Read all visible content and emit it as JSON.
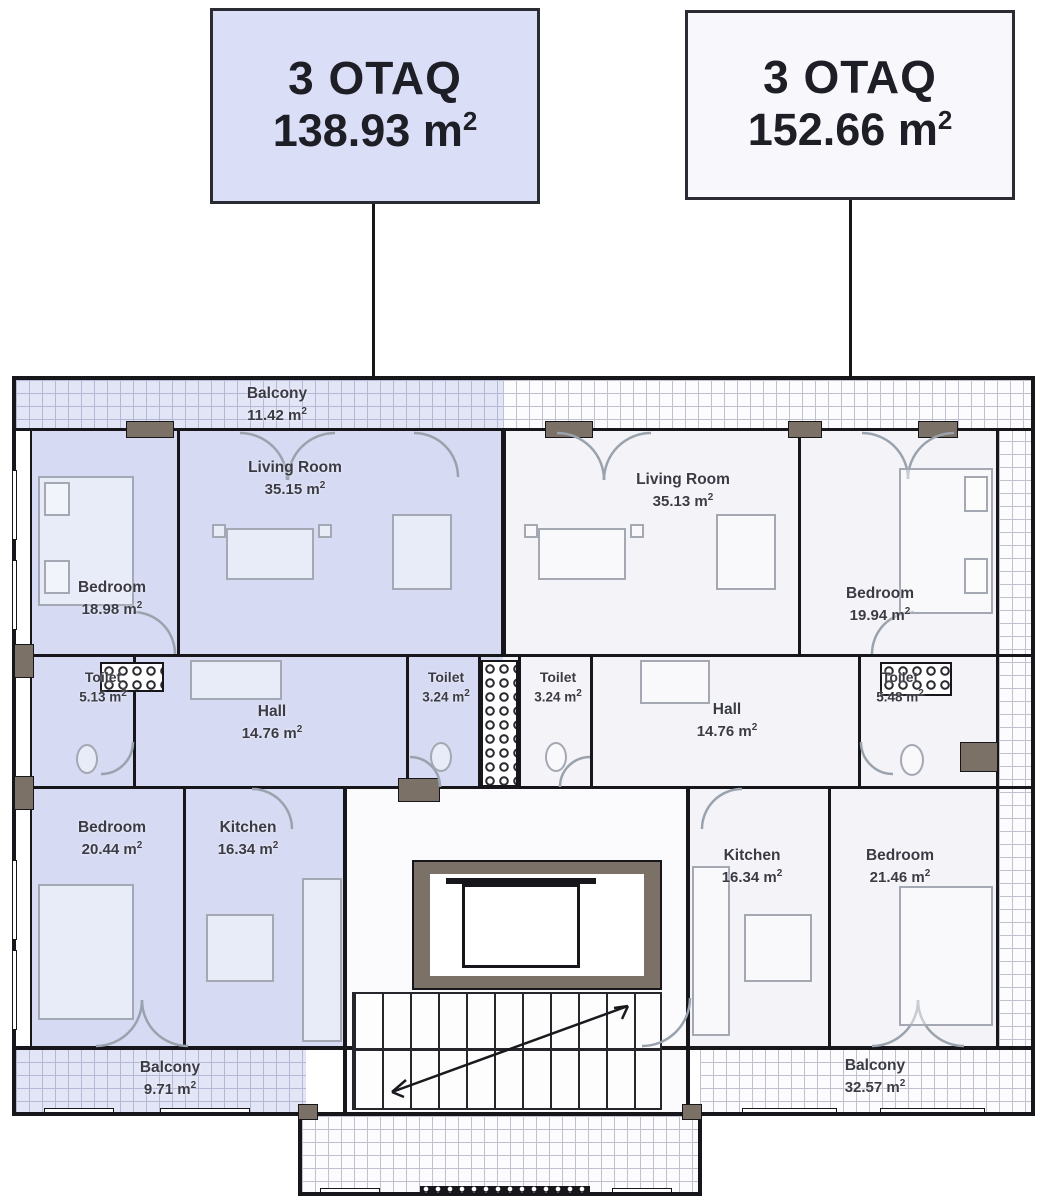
{
  "callouts": [
    {
      "title": "3 OTAQ",
      "area": "138.93"
    },
    {
      "title": "3 OTAQ",
      "area": "152.66"
    }
  ],
  "units": {
    "suffix": " m",
    "exp": "2"
  },
  "rooms": {
    "balcony_top": {
      "name": "Balcony",
      "area": "11.42"
    },
    "bedroom1": {
      "name": "Bedroom",
      "area": "18.98"
    },
    "living1": {
      "name": "Living Room",
      "area": "35.15"
    },
    "toilet1": {
      "name": "Toilet",
      "area": "5.13"
    },
    "hall1": {
      "name": "Hall",
      "area": "14.76"
    },
    "toilet2": {
      "name": "Toilet",
      "area": "3.24"
    },
    "bedroom2": {
      "name": "Bedroom",
      "area": "20.44"
    },
    "kitchen1": {
      "name": "Kitchen",
      "area": "16.34"
    },
    "balcony_left": {
      "name": "Balcony",
      "area": "9.71"
    },
    "living2": {
      "name": "Living Room",
      "area": "35.13"
    },
    "bedroom3": {
      "name": "Bedroom",
      "area": "19.94"
    },
    "toilet3": {
      "name": "Toilet",
      "area": "3.24"
    },
    "hall2": {
      "name": "Hall",
      "area": "14.76"
    },
    "toilet4": {
      "name": "Toilet",
      "area": "5.48"
    },
    "kitchen2": {
      "name": "Kitchen",
      "area": "16.34"
    },
    "bedroom4": {
      "name": "Bedroom",
      "area": "21.46"
    },
    "balcony_right": {
      "name": "Balcony",
      "area": "32.57"
    }
  },
  "colors": {
    "left_apartment_fill": "#d6daf2",
    "right_apartment_fill": "#f4f4f8",
    "callout_left_bg": "#dbdef7",
    "callout_right_bg": "#f8f8fc",
    "wall": "#17171b",
    "pier": "#7b7167"
  }
}
